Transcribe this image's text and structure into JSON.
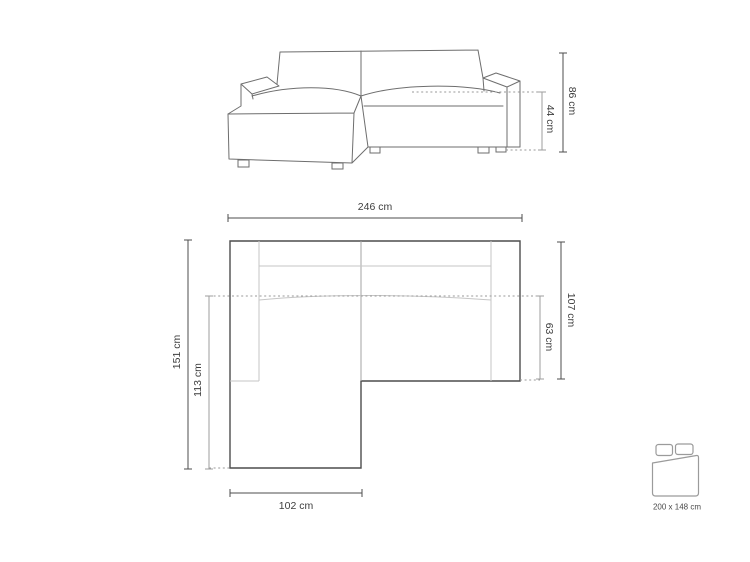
{
  "page": {
    "background": "#ffffff",
    "description": "Corner sofa technical dimension diagram: front elevation, top plan and sleeping-area pictogram"
  },
  "colors": {
    "sketch_line": "#6e6e6e",
    "plan_outline": "#4d4d4d",
    "plan_inner_line": "#c6c6c6",
    "dotted_line": "#9a9a9a",
    "dimension_dark": "#4d4d4d",
    "dimension_light": "#9e9e9e",
    "label_text": "#3d3d3d"
  },
  "front_view": {
    "total_height_label": "86 cm",
    "seat_height_label": "44 cm"
  },
  "top_view": {
    "total_width_label": "246 cm",
    "total_depth_label": "151 cm",
    "chaise_depth_label": "113 cm",
    "body_depth_label": "107 cm",
    "seat_depth_label": "63 cm",
    "chaise_width_label": "102 cm"
  },
  "sleeping_area": {
    "icon": "bed-icon",
    "label": "200 x 148 cm"
  }
}
